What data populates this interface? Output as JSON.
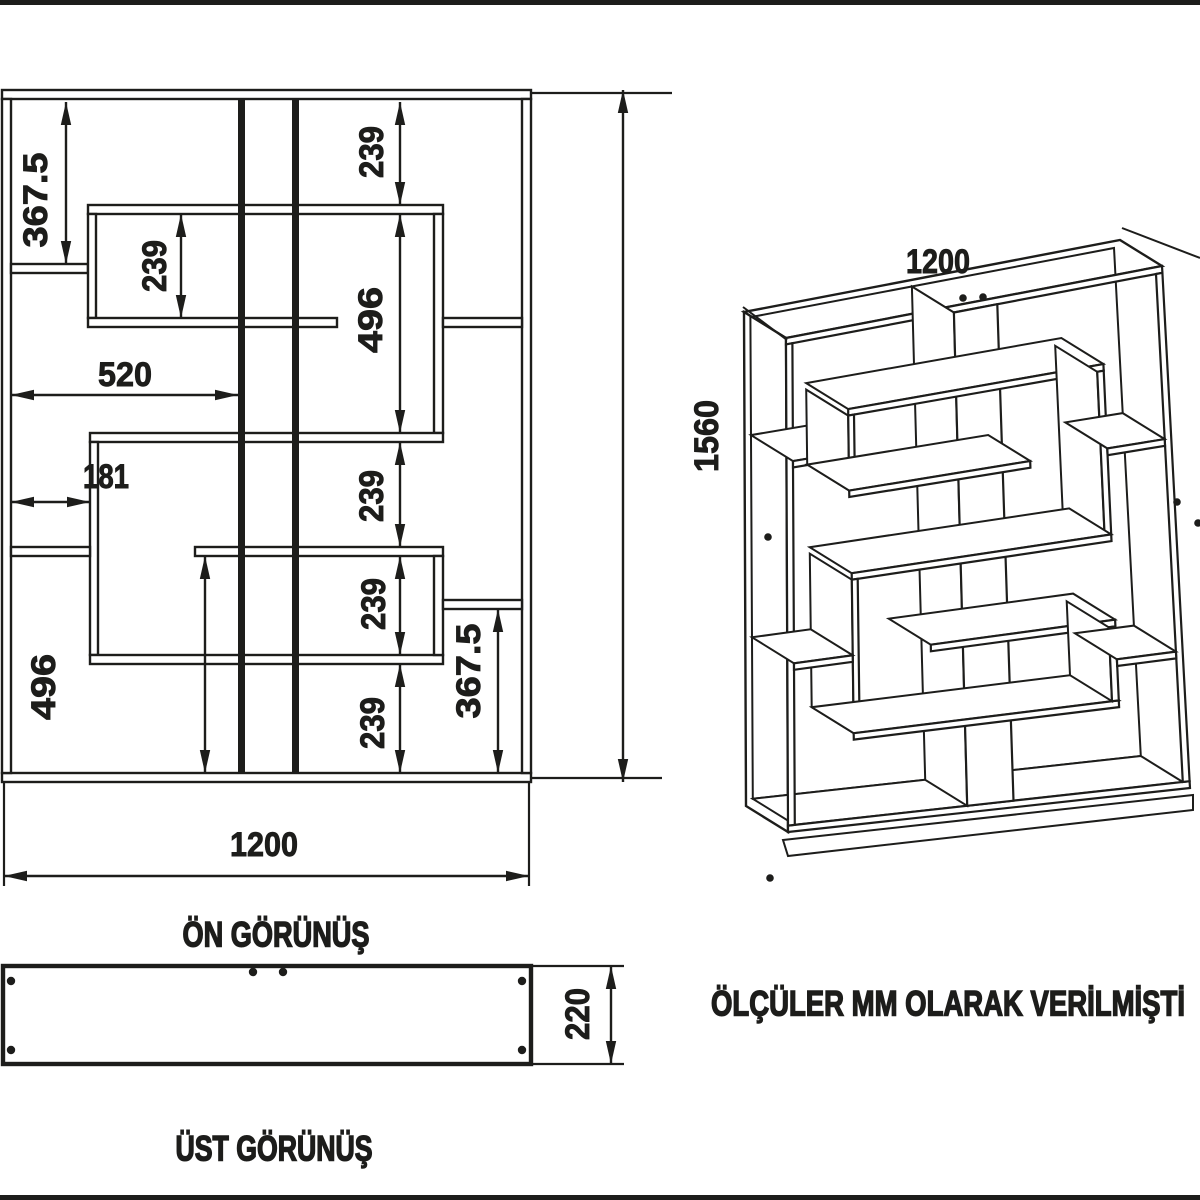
{
  "page": {
    "width": 1200,
    "height": 1200,
    "background": "#ffffff",
    "line_color": "#1d1d1b",
    "border_bars": [
      [
        0,
        0,
        1200,
        5
      ],
      [
        0,
        1195,
        1200,
        5
      ]
    ]
  },
  "titles": {
    "front_view": {
      "text": "ÖN GÖRÜNÜŞ",
      "x": 276,
      "y": 935,
      "len": 187
    },
    "top_view": {
      "text": "ÜST GÖRÜNÜŞ",
      "x": 274,
      "y": 1149,
      "len": 197
    },
    "note": {
      "text": "ÖLÇÜLER MM OLARAK VERİLMİŞTİ",
      "x": 948,
      "y": 1004,
      "len": 474
    }
  },
  "front_view": {
    "members": [
      {
        "name": "frame-top",
        "x1": 2,
        "y1": 90,
        "x2": 531,
        "y2": 99,
        "style": "panel",
        "iso": "frame"
      },
      {
        "name": "frame-bottom",
        "x1": 2,
        "y1": 773,
        "x2": 531,
        "y2": 782,
        "style": "panel",
        "iso": "frame"
      },
      {
        "name": "frame-left",
        "x1": 2,
        "y1": 99,
        "x2": 11,
        "y2": 773,
        "style": "panel",
        "iso": "frame"
      },
      {
        "name": "frame-right",
        "x1": 522,
        "y1": 99,
        "x2": 531,
        "y2": 773,
        "style": "panel",
        "iso": "frame"
      },
      {
        "name": "divider-v1",
        "x1": 238,
        "y1": 99,
        "x2": 245,
        "y2": 773,
        "style": "solid",
        "iso": "col"
      },
      {
        "name": "divider-v2",
        "x1": 292,
        "y1": 99,
        "x2": 299,
        "y2": 773,
        "style": "solid",
        "iso": "col"
      },
      {
        "name": "shelf-a",
        "x1": 11,
        "y1": 264,
        "x2": 88,
        "y2": 273,
        "style": "panel",
        "iso": "h"
      },
      {
        "name": "boxu-top",
        "x1": 88,
        "y1": 205,
        "x2": 443,
        "y2": 214,
        "style": "panel",
        "iso": "h"
      },
      {
        "name": "boxu-left",
        "x1": 88,
        "y1": 214,
        "x2": 96,
        "y2": 318,
        "style": "panel",
        "iso": "v"
      },
      {
        "name": "boxu-bottom",
        "x1": 88,
        "y1": 318,
        "x2": 337,
        "y2": 327,
        "style": "panel",
        "iso": "h"
      },
      {
        "name": "boxu-right",
        "x1": 434,
        "y1": 214,
        "x2": 443,
        "y2": 433,
        "style": "panel",
        "iso": "v"
      },
      {
        "name": "shelf-r1",
        "x1": 443,
        "y1": 318,
        "x2": 522,
        "y2": 327,
        "style": "panel",
        "iso": "h"
      },
      {
        "name": "boxl-top",
        "x1": 90,
        "y1": 433,
        "x2": 443,
        "y2": 442,
        "style": "panel",
        "iso": "h"
      },
      {
        "name": "boxl-left",
        "x1": 90,
        "y1": 442,
        "x2": 98,
        "y2": 655,
        "style": "panel",
        "iso": "v"
      },
      {
        "name": "boxl-bottom",
        "x1": 90,
        "y1": 655,
        "x2": 443,
        "y2": 664,
        "style": "panel",
        "iso": "h"
      },
      {
        "name": "shelf-m",
        "x1": 195,
        "y1": 547,
        "x2": 443,
        "y2": 556,
        "style": "panel",
        "iso": "h"
      },
      {
        "name": "shelf-m-right",
        "x1": 434,
        "y1": 556,
        "x2": 443,
        "y2": 655,
        "style": "panel",
        "iso": "v"
      },
      {
        "name": "shelf-b",
        "x1": 11,
        "y1": 547,
        "x2": 90,
        "y2": 556,
        "style": "panel",
        "iso": "h"
      },
      {
        "name": "shelf-r3",
        "x1": 443,
        "y1": 600,
        "x2": 522,
        "y2": 609,
        "style": "panel",
        "iso": "h"
      }
    ],
    "dimensions": [
      {
        "text": "367.5",
        "axis": "v",
        "x": 66,
        "y1": 102,
        "y2": 264,
        "lx": 36,
        "ly": 200,
        "len": 95
      },
      {
        "text": "239",
        "axis": "v",
        "x": 181,
        "y1": 214,
        "y2": 318,
        "lx": 155,
        "ly": 266,
        "len": 52
      },
      {
        "text": "239",
        "axis": "v",
        "x": 400,
        "y1": 102,
        "y2": 205,
        "lx": 372,
        "ly": 152,
        "len": 52
      },
      {
        "text": "496",
        "axis": "v",
        "x": 400,
        "y1": 214,
        "y2": 433,
        "lx": 371,
        "ly": 320,
        "len": 66
      },
      {
        "text": "520",
        "axis": "h",
        "y": 395,
        "x1": 11,
        "x2": 238,
        "lx": 125,
        "ly": 375,
        "len": 54
      },
      {
        "text": "181",
        "axis": "h",
        "y": 502,
        "x1": 11,
        "x2": 90,
        "lx": 106,
        "ly": 477,
        "len": 46
      },
      {
        "text": "239",
        "axis": "v",
        "x": 400,
        "y1": 442,
        "y2": 547,
        "lx": 372,
        "ly": 496,
        "len": 52
      },
      {
        "text": "239",
        "axis": "v",
        "x": 400,
        "y1": 556,
        "y2": 655,
        "lx": 374,
        "ly": 604,
        "len": 52
      },
      {
        "text": "239",
        "axis": "v",
        "x": 400,
        "y1": 664,
        "y2": 773,
        "lx": 373,
        "ly": 723,
        "len": 52
      },
      {
        "text": "367.5",
        "axis": "v",
        "x": 498,
        "y1": 609,
        "y2": 773,
        "lx": 469,
        "ly": 671,
        "len": 95
      },
      {
        "text": "496",
        "axis": "v",
        "x": 205,
        "y1": 556,
        "y2": 773,
        "lx": 44,
        "ly": 687,
        "len": 66
      },
      {
        "text": "1560",
        "axis": "v",
        "x": 623,
        "y1": 90,
        "y2": 782,
        "lx": 707,
        "ly": 436,
        "len": 72
      },
      {
        "text": "1200",
        "axis": "h",
        "y": 876,
        "x1": 4,
        "x2": 529,
        "lx": 264,
        "ly": 845,
        "len": 68
      }
    ],
    "extension_lines": [
      [
        531,
        93,
        672,
        93
      ],
      [
        531,
        778,
        662,
        778
      ],
      [
        4,
        783,
        4,
        886
      ],
      [
        529,
        783,
        529,
        886
      ]
    ]
  },
  "top_view": {
    "rect": [
      3,
      966,
      531,
      1064
    ],
    "dots": [
      [
        11,
        981
      ],
      [
        11,
        1050
      ],
      [
        522,
        981
      ],
      [
        522,
        1050
      ],
      [
        253,
        972
      ],
      [
        283,
        972
      ]
    ],
    "dimension": {
      "text": "220",
      "x": 611,
      "y1": 966,
      "y2": 1064,
      "lx": 578,
      "ly": 1014,
      "len": 52
    },
    "extension_lines": [
      [
        533,
        966,
        624,
        966
      ],
      [
        533,
        1064,
        624,
        1064
      ]
    ]
  },
  "iso_view": {
    "label": {
      "text": "1200",
      "x": 938,
      "y": 262,
      "len": 64
    },
    "corners": {
      "ftl": [
        786,
        338
      ],
      "ftr": [
        1162,
        266
      ],
      "fbr": [
        1190,
        788
      ],
      "fbl": [
        788,
        832
      ]
    },
    "depth": [
      -42,
      -26
    ],
    "leaders": [
      [
        743,
        307,
        787,
        340
      ],
      [
        1122,
        228,
        1200,
        258
      ]
    ],
    "base_lip": {
      "top": [
        783,
        840,
        1193,
        795
      ],
      "bottom": [
        788,
        856,
        1193,
        810
      ]
    },
    "dots": [
      [
        768,
        537
      ],
      [
        770,
        878
      ],
      [
        963,
        298
      ],
      [
        983,
        297
      ],
      [
        1177,
        502
      ],
      [
        1198,
        523
      ]
    ]
  }
}
